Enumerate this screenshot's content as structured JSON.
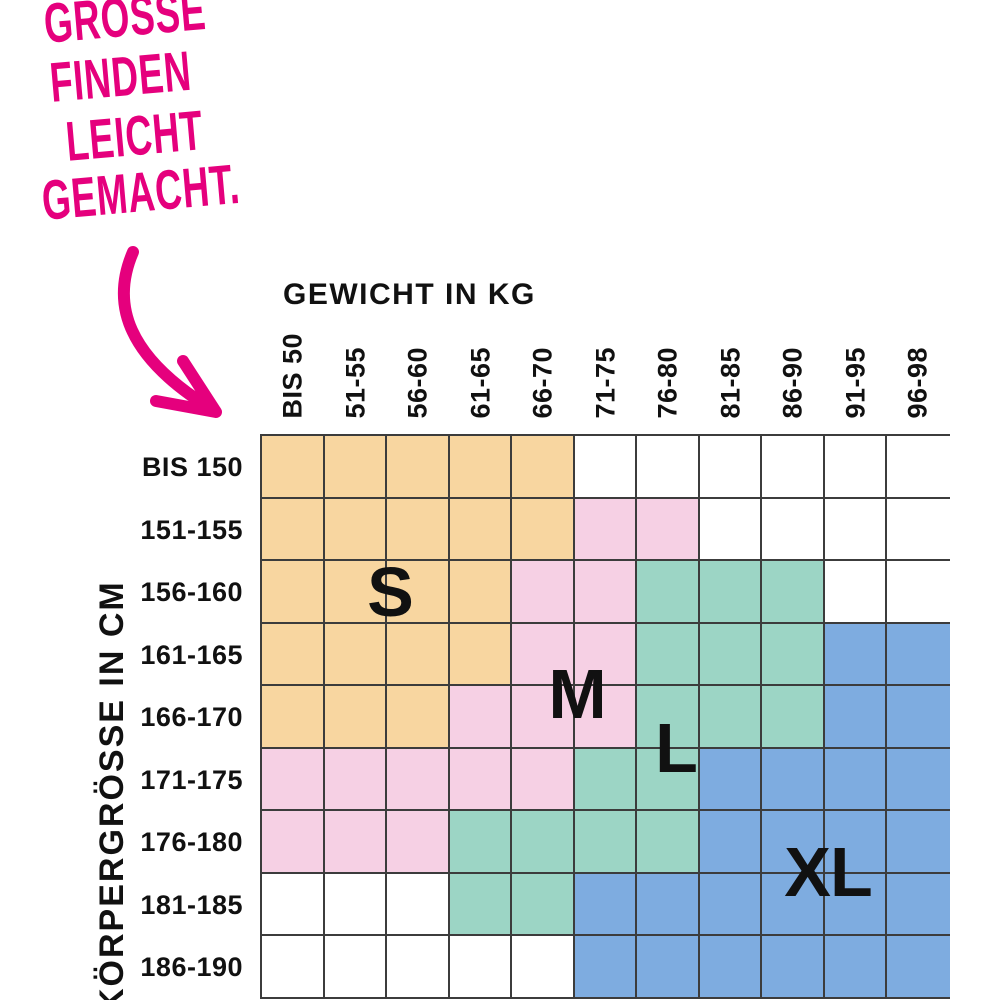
{
  "headline": {
    "lines": [
      "GRÖSSE",
      "FINDEN",
      "LEICHT",
      "GEMACHT."
    ]
  },
  "axes": {
    "x_title": "GEWICHT IN KG",
    "y_title": "KÖRPERGRÖSSE IN CM"
  },
  "sizes": [
    {
      "label": "S",
      "color": "#F8D6A0"
    },
    {
      "label": "M",
      "color": "#F6D0E4"
    },
    {
      "label": "L",
      "color": "#9CD5C5"
    },
    {
      "label": "XL",
      "color": "#7EACE0"
    }
  ],
  "colors": {
    "accent": "#E5007D",
    "grid_line": "#3C3C3C",
    "text": "#111111"
  },
  "chart_data": {
    "type": "heatmap",
    "title": "GRÖSSE FINDEN LEICHT GEMACHT.",
    "xlabel": "GEWICHT IN KG",
    "ylabel": "KÖRPERGRÖSSE IN CM",
    "x_categories": [
      "BIS 50",
      "51-55",
      "56-60",
      "61-65",
      "66-70",
      "71-75",
      "76-80",
      "81-85",
      "86-90",
      "91-95",
      "96-98"
    ],
    "y_categories": [
      "BIS 150",
      "151-155",
      "156-160",
      "161-165",
      "166-170",
      "171-175",
      "176-180",
      "181-185",
      "186-190"
    ],
    "legend": {
      "S": "#F8D6A0",
      "M": "#F6D0E4",
      "L": "#9CD5C5",
      "XL": "#7EACE0"
    },
    "cell_values": [
      [
        "S",
        "S",
        "S",
        "S",
        "S",
        "",
        "",
        "",
        "",
        "",
        ""
      ],
      [
        "S",
        "S",
        "S",
        "S",
        "S",
        "M",
        "M",
        "",
        "",
        "",
        ""
      ],
      [
        "S",
        "S",
        "S",
        "S",
        "M",
        "M",
        "L",
        "L",
        "L",
        "",
        ""
      ],
      [
        "S",
        "S",
        "S",
        "S",
        "M",
        "M",
        "L",
        "L",
        "L",
        "XL",
        "XL"
      ],
      [
        "S",
        "S",
        "S",
        "M",
        "M",
        "M",
        "L",
        "L",
        "L",
        "XL",
        "XL"
      ],
      [
        "M",
        "M",
        "M",
        "M",
        "M",
        "L",
        "L",
        "XL",
        "XL",
        "XL",
        "XL"
      ],
      [
        "M",
        "M",
        "M",
        "L",
        "L",
        "L",
        "L",
        "XL",
        "XL",
        "XL",
        "XL"
      ],
      [
        "",
        "",
        "",
        "L",
        "L",
        "XL",
        "XL",
        "XL",
        "XL",
        "XL",
        "XL"
      ],
      [
        "",
        "",
        "",
        "",
        "",
        "XL",
        "XL",
        "XL",
        "XL",
        "XL",
        "XL"
      ]
    ],
    "grid": "on",
    "legend_position": "inline-letters"
  }
}
